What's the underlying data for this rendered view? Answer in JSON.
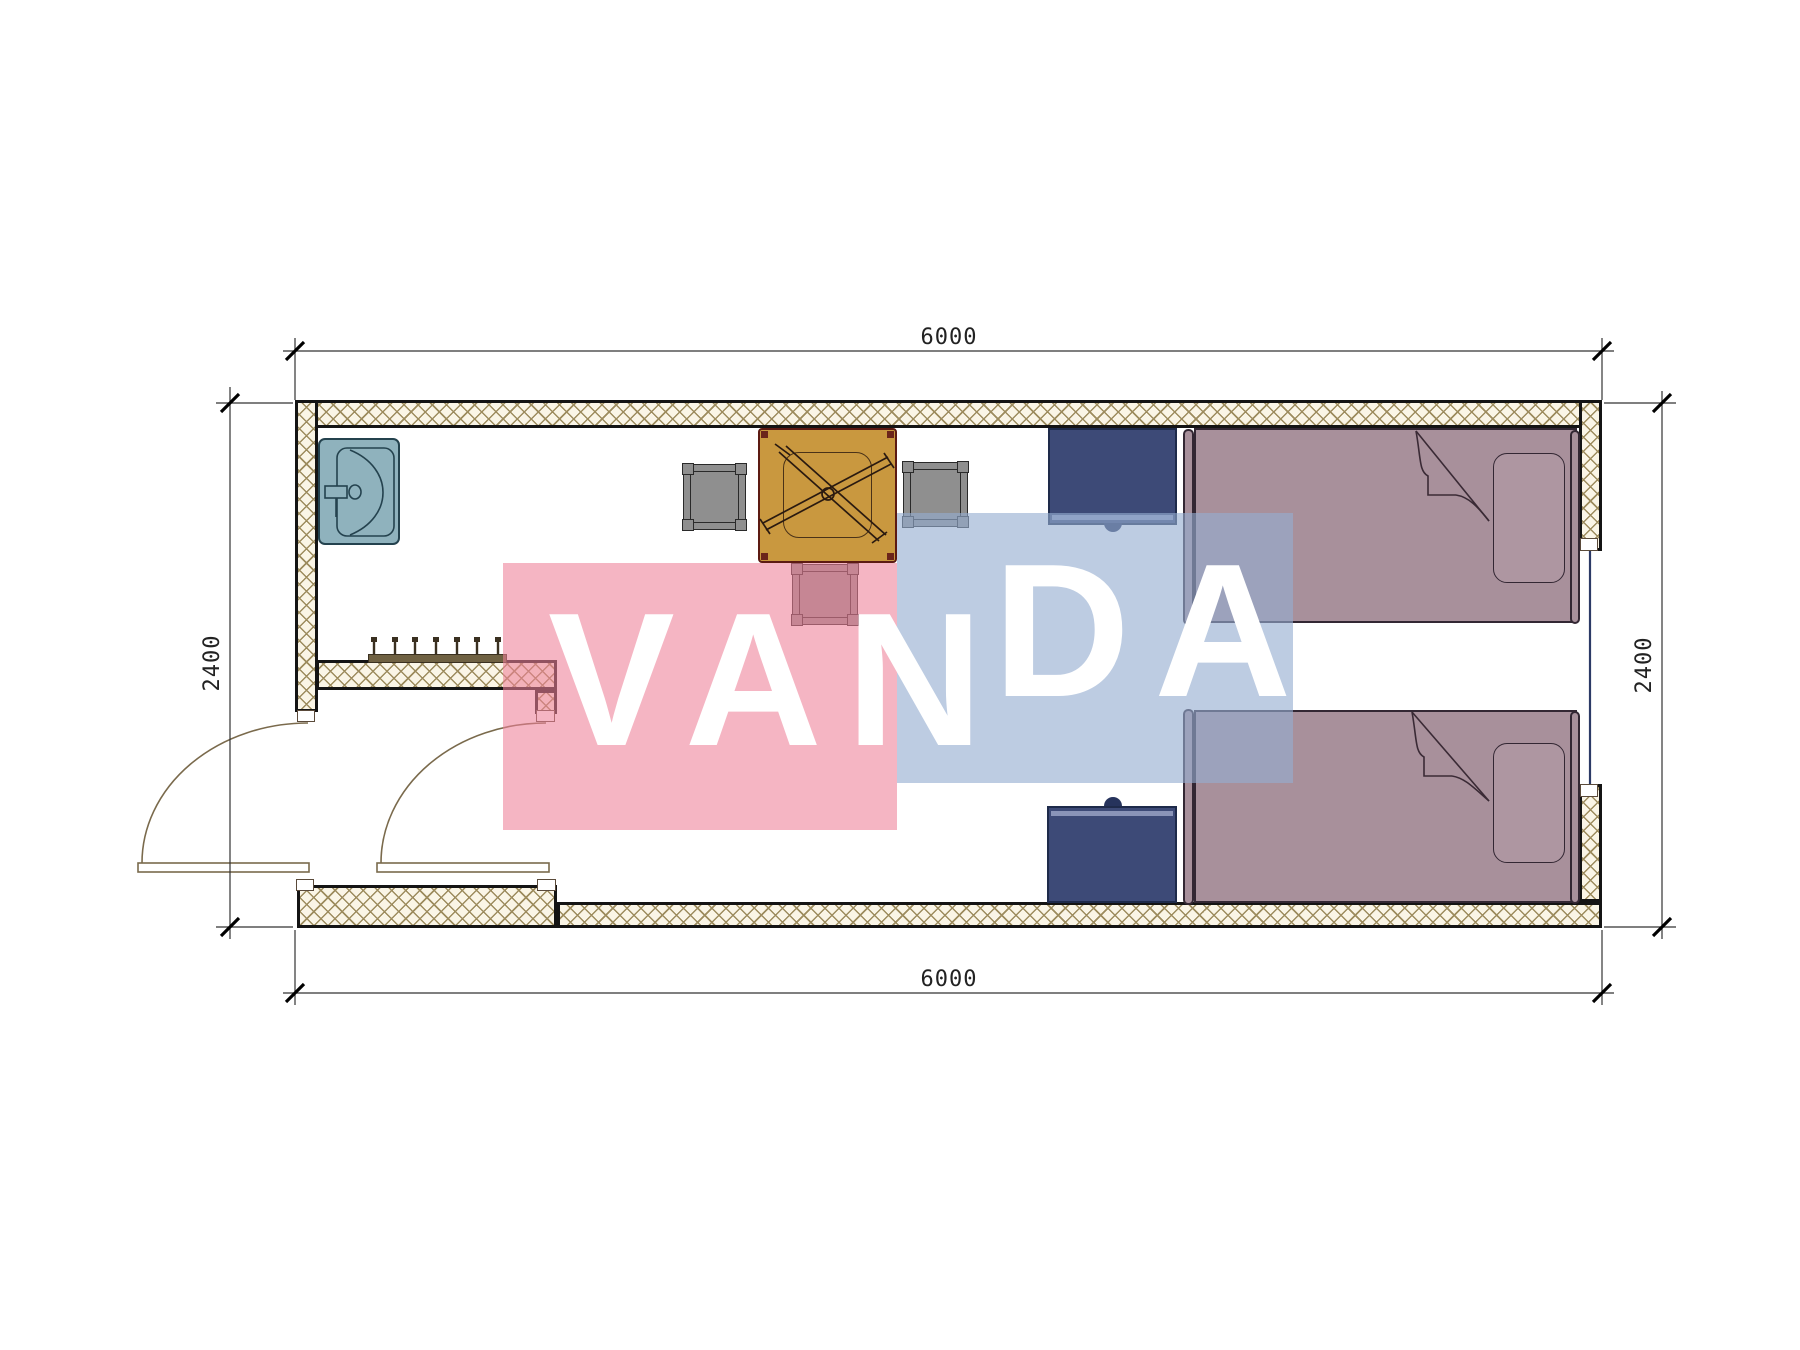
{
  "plan_title": "container-room-floor-plan",
  "dimensions": {
    "top": "6000",
    "bottom": "6000",
    "left": "2400",
    "right": "2400"
  },
  "watermark": {
    "brand": "VANDA",
    "part1": "VAN",
    "part2": "DA"
  },
  "palette": {
    "wall-line": "#141414",
    "hatch-line": "#9d8c5e",
    "hatch-bg": "#faf5e6",
    "sink-fill": "#8fb2bd",
    "sink-line": "#24424e",
    "table-fill": "#c9983f",
    "table-line": "#5c1a12",
    "chair-fill": "#8f8f8f",
    "chair-line": "#2a2a2a",
    "bed-fill": "#a8909b",
    "bed-line": "#332733",
    "pillow-fill": "#ae96a1",
    "nightstand-fill": "#3d4a77",
    "nightstand-line": "#1e2a4a",
    "nightstand-accent": "#8a94b8",
    "door-line": "#7a6a4c",
    "window-line": "#2c3a66",
    "dim-line": "#333333",
    "dim-text": "#222222",
    "watermark-pink": "rgba(238,128,152,0.58)",
    "watermark-blue": "rgba(148,172,208,0.62)",
    "watermark-text": "#ffffff"
  },
  "elements": [
    "exterior-wall",
    "partition-wall",
    "entry-door-left",
    "entry-door-right",
    "window",
    "sink",
    "coat-rack",
    "dining-table",
    "chair-left",
    "chair-right",
    "chair-bottom",
    "nightstand-top",
    "nightstand-bottom",
    "single-bed-top",
    "single-bed-bottom"
  ]
}
